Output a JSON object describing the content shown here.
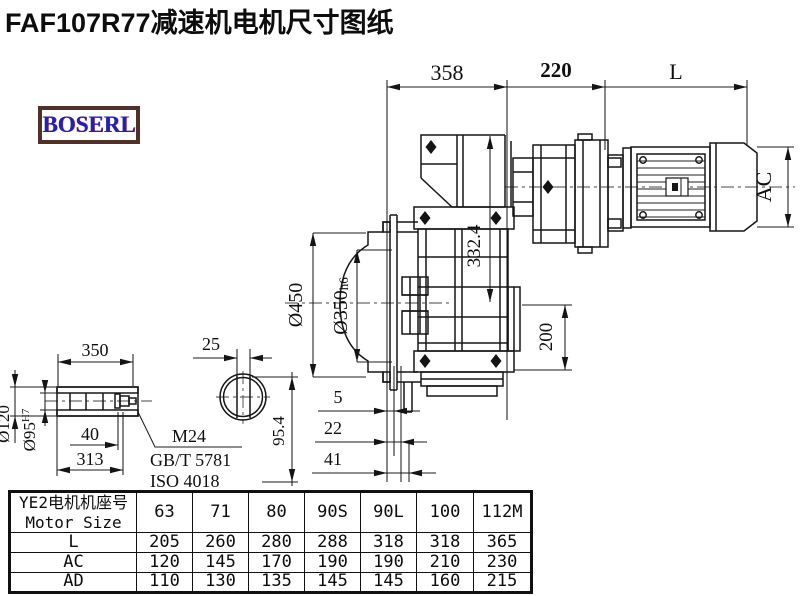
{
  "page": {
    "title": "FAF107R77减速机电机尺寸图纸",
    "logo": "BOSERL"
  },
  "drawing": {
    "labels": {
      "dim_358": "358",
      "dim_220": "220",
      "dim_L": "L",
      "dim_AC": "AC",
      "dim_d450": "Ø450",
      "dim_d350": "Ø350",
      "dim_d350_tol": "h6",
      "dim_332_4": "332.4",
      "dim_200": "200",
      "dim_350": "350",
      "dim_25": "25",
      "dim_d120": "Ø120",
      "dim_d95": "Ø95",
      "dim_d95_tol": "H7",
      "dim_40": "40",
      "dim_313": "313",
      "callout_bolt": "M24",
      "callout_std_gb": "GB/T 5781",
      "callout_std_iso": "ISO 4018",
      "dim_95_4": "95.4",
      "dim_5": "5",
      "dim_22": "22",
      "dim_41": "41"
    }
  },
  "table": {
    "header_cn": "YE2电机机座号",
    "header_en": "Motor Size",
    "columns": [
      "63",
      "71",
      "80",
      "90S",
      "90L",
      "100",
      "112M"
    ],
    "rows": [
      {
        "label": "L",
        "values": [
          "205",
          "260",
          "280",
          "288",
          "318",
          "318",
          "365"
        ]
      },
      {
        "label": "AC",
        "values": [
          "120",
          "145",
          "170",
          "190",
          "190",
          "210",
          "230"
        ]
      },
      {
        "label": "AD",
        "values": [
          "110",
          "130",
          "135",
          "145",
          "145",
          "160",
          "215"
        ]
      }
    ]
  },
  "colors": {
    "line": "#161616",
    "logo_text": "#2121b5",
    "logo_border": "#503129"
  }
}
